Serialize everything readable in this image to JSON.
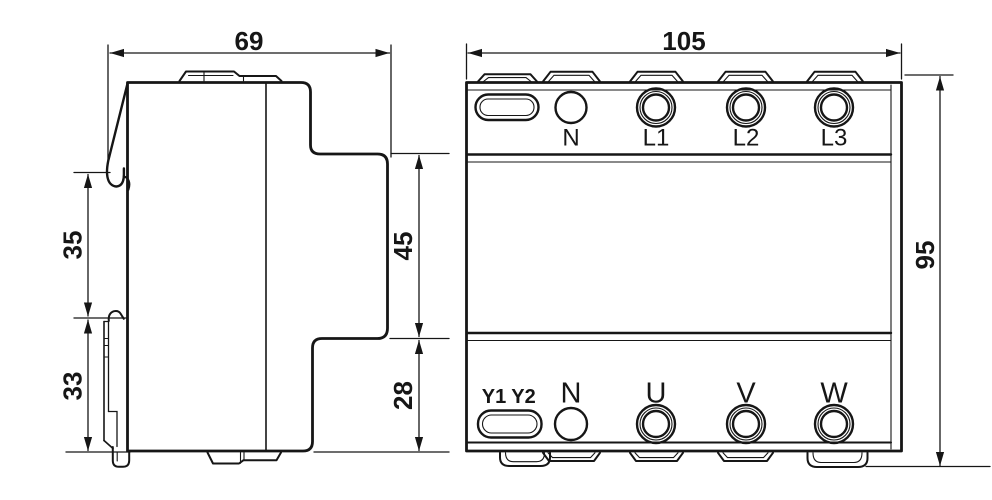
{
  "canvas": {
    "background": "#ffffff",
    "line_color": "#161616"
  },
  "side_view": {
    "dim_overall_depth": "69",
    "dim_upper_left_height": "35",
    "dim_lower_left_height": "33",
    "dim_front_upper_height": "45",
    "dim_front_lower_height": "28"
  },
  "front_view": {
    "dim_overall_width": "105",
    "dim_overall_height": "95",
    "top_terminal_labels": [
      "N",
      "L1",
      "L2",
      "L3"
    ],
    "bottom_aux_labels": [
      "Y1",
      "Y2"
    ],
    "bottom_terminal_labels": [
      "N",
      "U",
      "V",
      "W"
    ]
  }
}
